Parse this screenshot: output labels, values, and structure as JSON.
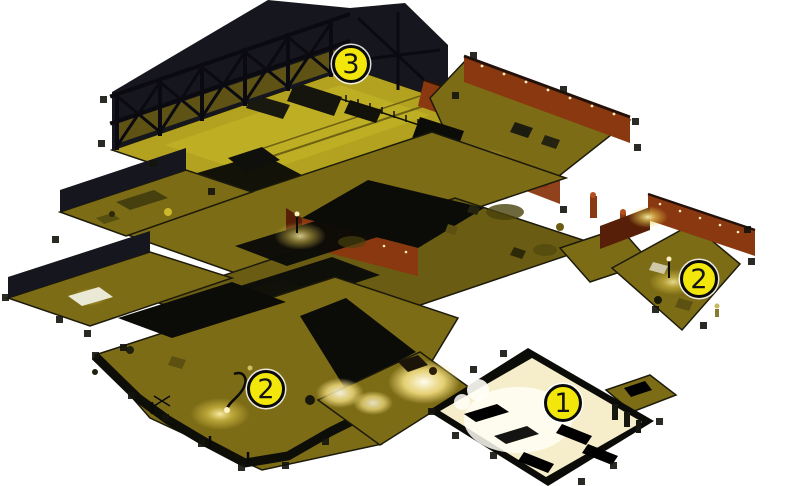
{
  "map": {
    "markers": [
      {
        "label": "3",
        "x": 351,
        "y": 64
      },
      {
        "label": "2",
        "x": 699,
        "y": 279
      },
      {
        "label": "2",
        "x": 266,
        "y": 389
      },
      {
        "label": "1",
        "x": 563,
        "y": 403
      }
    ],
    "marker_style": {
      "radius": 19,
      "border_width": 3,
      "font_size": 27,
      "fill": "#f2e60a",
      "border_color": "#0a0a0a",
      "text_color": "#141414",
      "halo_color": "rgba(255,255,255,0.85)"
    }
  },
  "palette": {
    "background": "#ffffff",
    "floor_olive": "#7d6c16",
    "floor_bright": "#b2a21f",
    "floor_dim": "#6a5c12",
    "wall_dark": "#16161e",
    "roof_black": "#0b0b08",
    "rust": "#8a3810",
    "rust_dark": "#571f08",
    "rust_light": "#b1501e",
    "lit_floor": "#f6eecb",
    "glow_warm": "#ffe88c"
  }
}
